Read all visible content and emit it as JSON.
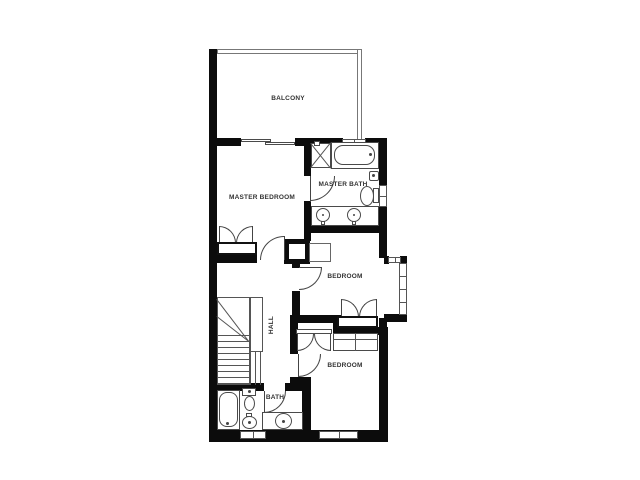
{
  "rooms": {
    "balcony": {
      "label": "BALCONY"
    },
    "master_bedroom": {
      "label": "MASTER BEDROOM"
    },
    "master_bath": {
      "label": "MASTER BATH"
    },
    "bedroom_upper": {
      "label": "BEDROOM"
    },
    "bedroom_lower": {
      "label": "BEDROOM"
    },
    "hall": {
      "label": "HALL"
    },
    "bath": {
      "label": "BATH"
    }
  },
  "fixtures": [
    "shower",
    "bathtub-horizontal",
    "bathtub-vertical",
    "toilet",
    "toilet-paper-holder",
    "double-vanity-sinks",
    "vanity-washbasin",
    "bidet",
    "stairs",
    "closet-double-doors",
    "wardrobe",
    "cabinet",
    "bay-window",
    "sliding-balcony-door"
  ],
  "colors": {
    "wall": "#0c0c0c",
    "thin_line": "#4a4a4a",
    "window_line": "#555555",
    "background": "#ffffff",
    "label_text": "#333333"
  }
}
